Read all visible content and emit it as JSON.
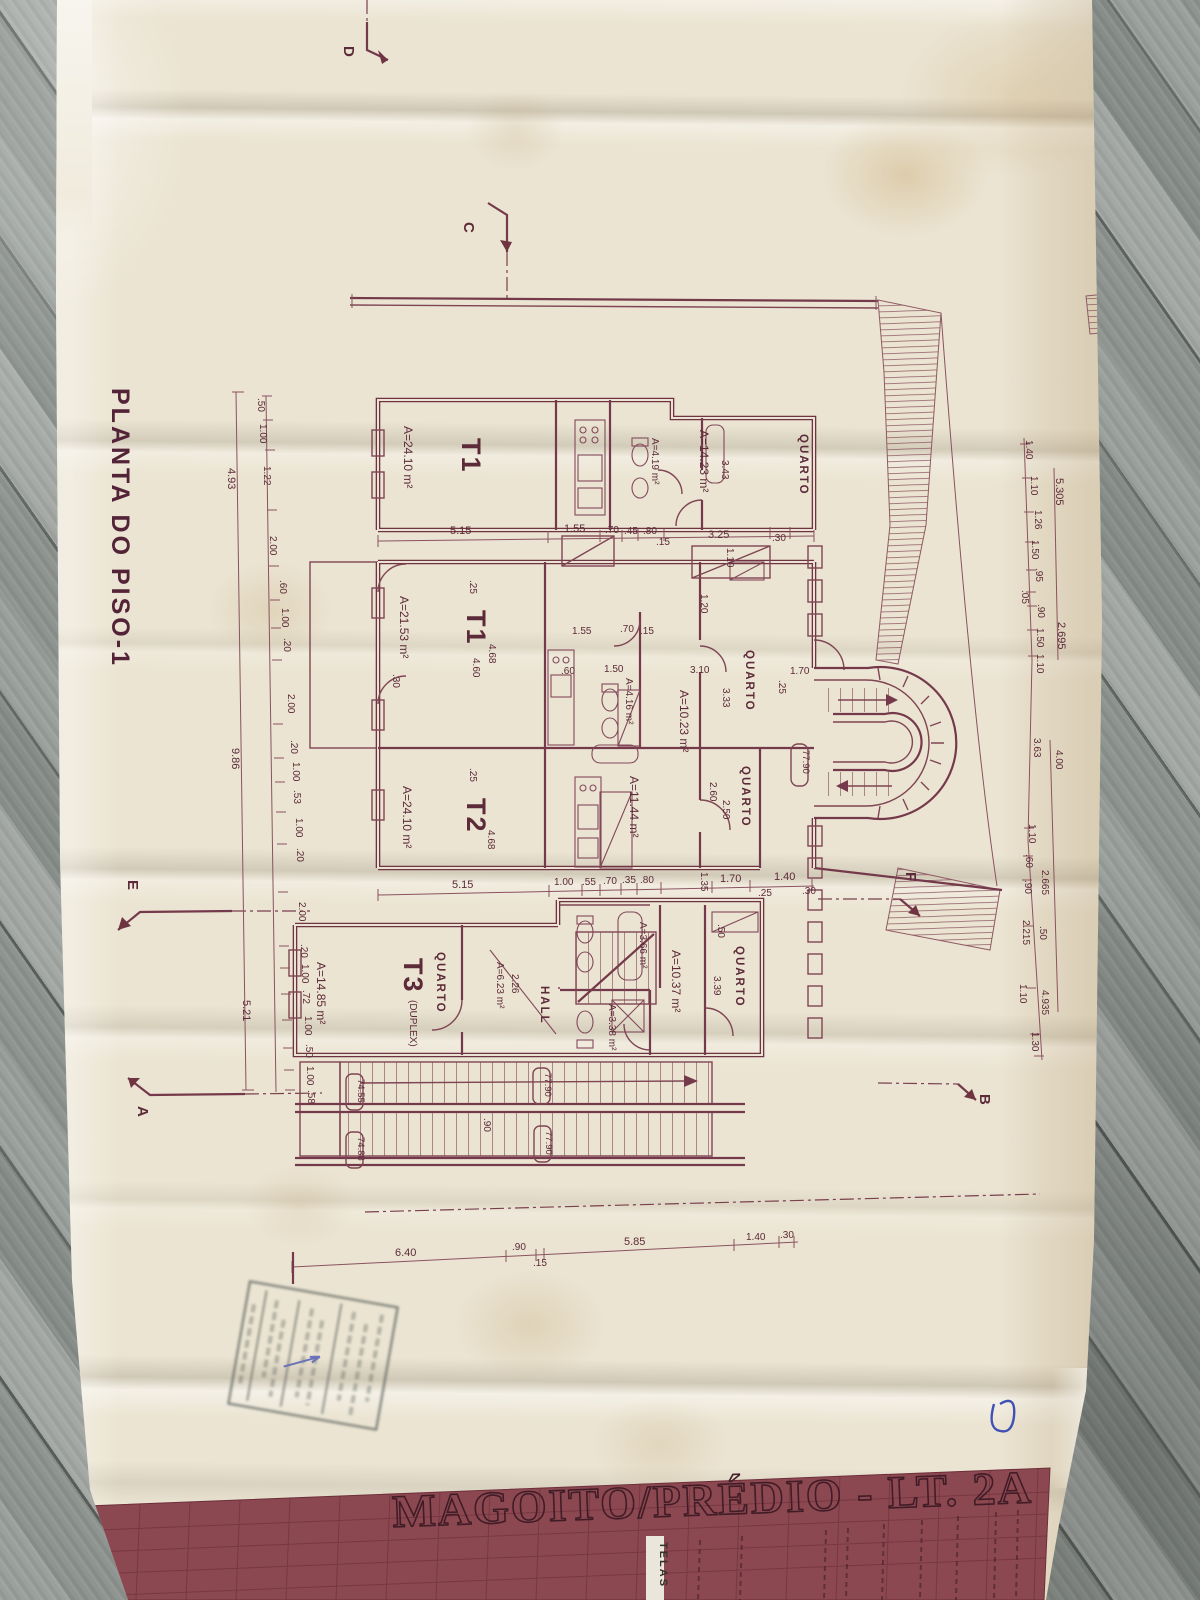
{
  "plan": {
    "title": "PLANTA DO PISO-1",
    "sheet_title": "MAGOITO/PRÉDIO - LT. 2A",
    "block_tag": "TELAS"
  },
  "sections": {
    "a": "A",
    "b": "B",
    "c": "C",
    "d": "D",
    "e": "E",
    "f": "F"
  },
  "units": {
    "t1a": {
      "name": "T1",
      "area": "A=24.10 m²"
    },
    "t1b": {
      "name": "T1",
      "area": "A=21.53 m²"
    },
    "t2": {
      "name": "T2",
      "area": "A=24.10 m²"
    },
    "t3": {
      "name": "T3",
      "suffix": "(DUPLEX)",
      "area": "A=14.85 m²"
    }
  },
  "rooms": {
    "quarto": "QUARTO",
    "hall": "HALL"
  },
  "areas": {
    "bath_top": "A=4.19 m²",
    "bed_top": "A=14.23 m²",
    "bath_mid": "A=4.16 m²",
    "bed_a": "A=10.23 m²",
    "bed_b": "A=11.44 m²",
    "bed_c": "A=10.37 m²",
    "stair": "A=6.23 m²",
    "stair_w": "2.26",
    "bath_b": "A=3.66 m²",
    "wc": "A=3.38 m²"
  },
  "levels": {
    "upper": "77.90",
    "low_a": "74.55",
    "low_b": "74.88"
  },
  "dims": {
    "left_totals": [
      "4.93",
      "9.86",
      "5.21"
    ],
    "left": [
      ".50",
      "1.00",
      "1.22",
      "2.00",
      ".60",
      "1.00",
      ".20",
      "2.00",
      ".20",
      "1.00",
      ".53",
      "1.00",
      ".20",
      "2.00",
      ".20",
      "1.00",
      ".72",
      "1.00",
      ".50",
      "1.00",
      ".58"
    ],
    "right_totals": [
      "5.305",
      "2.695"
    ],
    "right": [
      "1.40",
      "1.10",
      "1.26",
      "1.50",
      ".95",
      ".05",
      ".90",
      "1.50",
      "1.10",
      "3.63",
      "4.00",
      "1.10",
      ".60",
      ".90",
      "2.665",
      "2.215",
      ".50",
      "1.10",
      "4.935",
      "1.30"
    ],
    "top": [
      "5.15",
      "1.55",
      ".70",
      ".45",
      ".80",
      "3.25",
      ".30",
      "3.43",
      "1.10",
      ".15"
    ],
    "mid": [
      "5.15",
      "1.00",
      ".55",
      ".70",
      ".35",
      ".80",
      "1.35",
      "1.70",
      "1.40",
      ".25",
      ".30"
    ],
    "inner": [
      ".25",
      "4.68",
      "4.60",
      ".30",
      "1.55",
      ".70",
      ".15",
      ".60",
      "1.50",
      "3.10",
      "3.33",
      "1.20",
      ".25",
      "4.68",
      "2.60",
      "1.70",
      ".25",
      ".50",
      "3.39",
      "2.50"
    ],
    "bottom": [
      "6.40",
      ".90",
      ".15",
      "5.85",
      "1.40",
      ".30"
    ],
    "extra": [
      ".90"
    ]
  }
}
